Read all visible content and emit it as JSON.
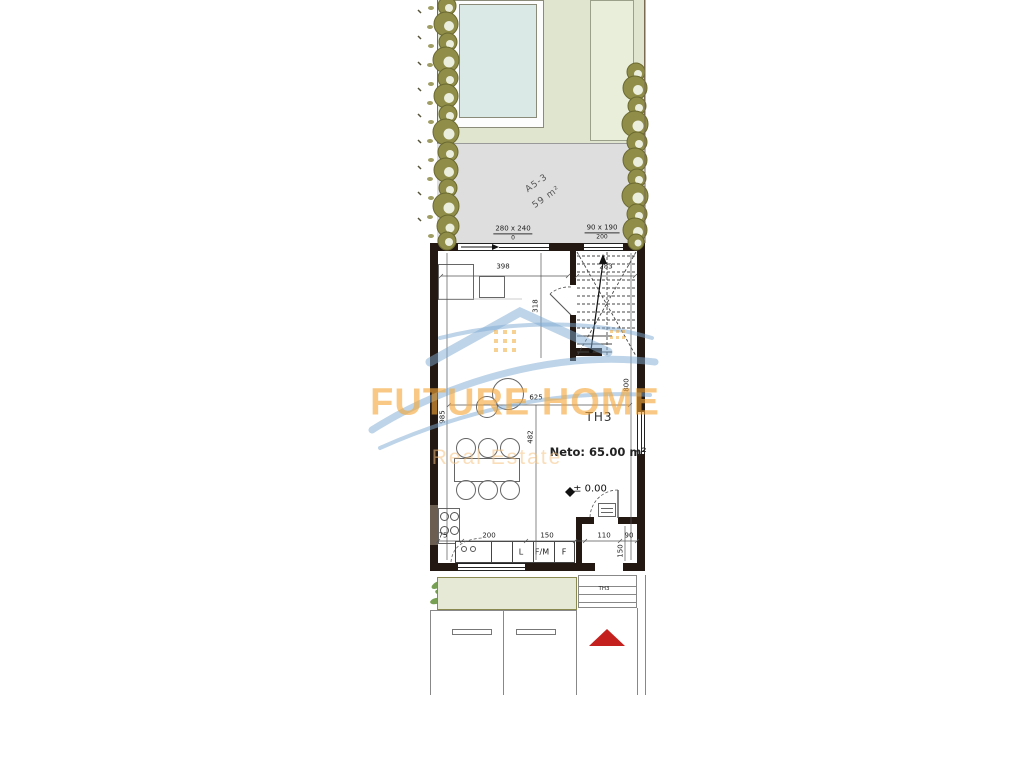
{
  "watermark": {
    "brand": "FUTURE HOME",
    "tagline": "Real Estate"
  },
  "site": {
    "terrace_unit": "A5-3",
    "terrace_area": "59 m²"
  },
  "openings": {
    "window_left": {
      "size": "280 x 240",
      "sill": "0"
    },
    "window_right": {
      "size": "90 x 190",
      "sill": "200"
    },
    "planter": {
      "size": "260 x 140",
      "sill": "100"
    }
  },
  "dims": {
    "d398": "398",
    "d283": "283",
    "d318": "318",
    "d985": "985",
    "d625": "625",
    "d482": "482",
    "d800": "800",
    "d75": "75",
    "d200": "200",
    "d150": "150",
    "d110": "110",
    "d90": "90",
    "d150v": "150"
  },
  "unit": {
    "name": "TH3",
    "net": "Neto: 65.00 m²",
    "level": "± 0.00"
  },
  "kitchen": {
    "l": "L",
    "fm": "F/M",
    "f": "F"
  },
  "entry": {
    "label": "TH3"
  },
  "colors": {
    "wall": "#241812",
    "garden_green": "#e0e5cf",
    "terrace_gray": "#dedede",
    "pool_blue": "#dbe9e6",
    "tree_olive": "#8f8d48",
    "arrow_red": "#c4201d",
    "watermark_orange": "#f3a63c",
    "watermark_blue": "#86b4d8"
  }
}
